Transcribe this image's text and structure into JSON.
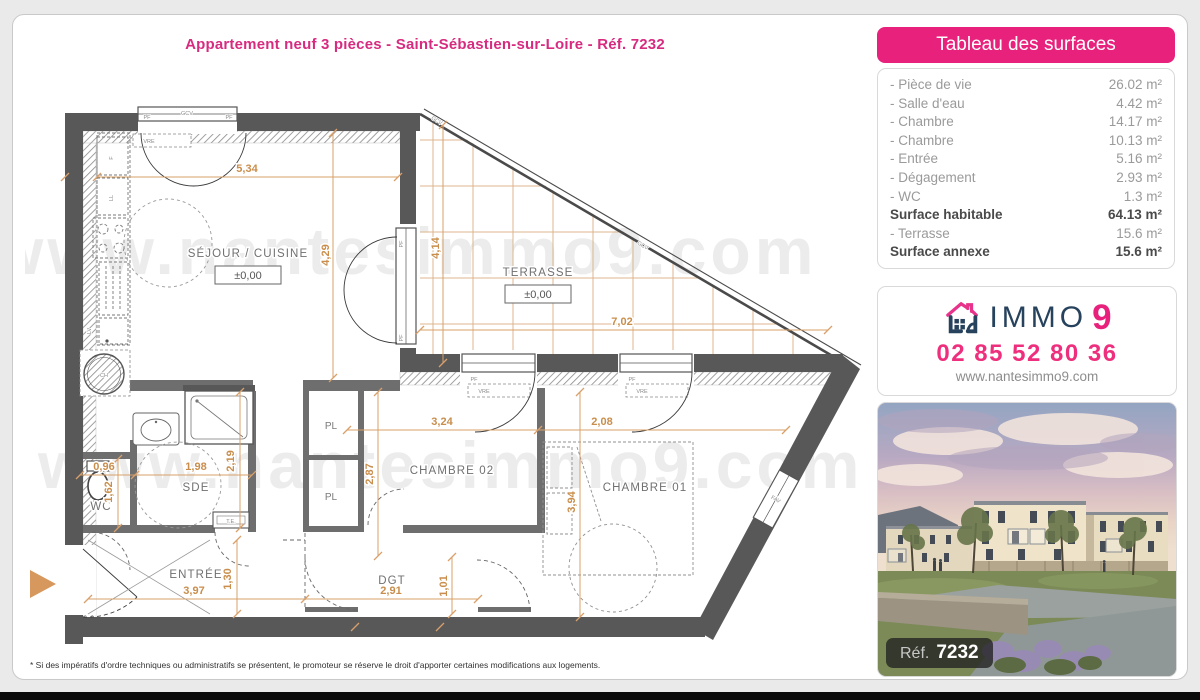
{
  "page": {
    "title": "Appartement neuf 3 pièces - Saint-Sébastien-sur-Loire - Réf. 7232",
    "disclaimer": "* Si des impératifs d'ordre techniques ou administratifs se présentent, le promoteur se réserve le droit d'apporter certaines modifications aux logements."
  },
  "surfaces": {
    "header": "Tableau des surfaces",
    "rows": [
      {
        "label": "- Pièce de vie",
        "value": "26.02 m²"
      },
      {
        "label": "- Salle d'eau",
        "value": "4.42 m²"
      },
      {
        "label": "- Chambre",
        "value": "14.17 m²"
      },
      {
        "label": "- Chambre",
        "value": "10.13 m²"
      },
      {
        "label": "- Entrée",
        "value": "5.16 m²"
      },
      {
        "label": "- Dégagement",
        "value": "2.93 m²"
      },
      {
        "label": "- WC",
        "value": "1.3 m²"
      },
      {
        "label": "Surface habitable",
        "value": "64.13 m²"
      },
      {
        "label": "- Terrasse",
        "value": "15.6 m²"
      },
      {
        "label": "Surface annexe",
        "value": "15.6 m²"
      }
    ]
  },
  "agency": {
    "brand_immo": "IMMO",
    "brand_9": "9",
    "phone": "02 85 52 80 36",
    "website": "www.nantesimmo9.com"
  },
  "photo": {
    "ref_label": "Réf.",
    "ref_number": "7232"
  },
  "plan": {
    "watermark": "www.nantesimmo9.com",
    "rooms": {
      "sejour": "SÉJOUR / CUISINE",
      "terrasse": "TERRASSE",
      "ch02": "CHAMBRE 02",
      "ch01": "CHAMBRE 01",
      "sde": "SDE",
      "wc": "WC",
      "entree": "ENTRÉE",
      "dgt": "DGT",
      "pl": "PL"
    },
    "levels": {
      "sejour": "±0,00",
      "terrasse": "±0,00"
    },
    "dims": {
      "sejour_w": "5,34",
      "sejour_h": "4,29",
      "terrasse_h": "4,14",
      "terrasse_w": "7,02",
      "ch02_w": "3,24",
      "ch01_w": "2,08",
      "ch02_h": "2,87",
      "ch01_h": "3,94",
      "wc_w": "0,96",
      "sde_w": "1,98",
      "sde_h": "2,19",
      "wc_h": "1,62",
      "entree_w": "3,97",
      "entree_h": "1,30",
      "dgt_w": "2,91",
      "dgt_h": "1,01"
    },
    "tags": {
      "gcv": "GCV",
      "pf": "PF",
      "vre": "VRE",
      "fav": "FAV",
      "te": "T.E.",
      "ch": "CH",
      "f": "F",
      "ll": "LL",
      "lv": "LV"
    }
  },
  "colors": {
    "accent": "#e8217c",
    "navy": "#27425c",
    "dim_line": "#d6985c"
  }
}
